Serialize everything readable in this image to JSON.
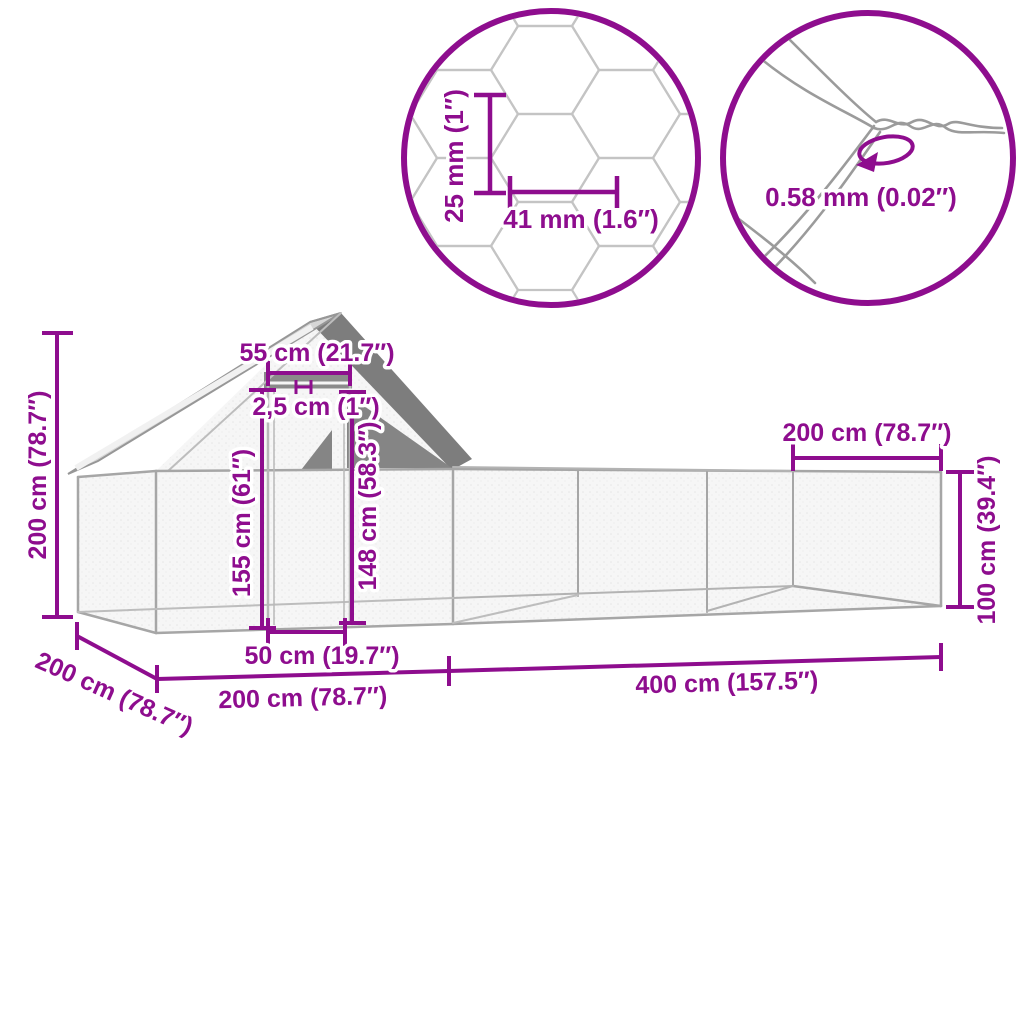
{
  "accent": "#8E0D8E",
  "structure_gray": "#a6a6a6",
  "roof_gray": "#d6d6d6",
  "shade_gray": "#828282",
  "labels": {
    "inset_mesh_height": "25 mm (1″)",
    "inset_mesh_width": "41 mm (1.6″)",
    "inset_wire_thickness": "0.58 mm (0.02″)",
    "total_height": "200 cm (78.7″)",
    "ridge_width": "55 cm (21.7″)",
    "panel_gap": "2,5 cm (1″)",
    "door_height": "155 cm (61″)",
    "opening_height": "148 cm (58.3″)",
    "end_width": "200 cm (78.7″)",
    "run_wall_height": "100 cm (39.4″)",
    "door_width": "50 cm (19.7″)",
    "depth": "200 cm (78.7″)",
    "coop_length": "200 cm (78.7″)",
    "run_length": "400 cm (157.5″)"
  }
}
